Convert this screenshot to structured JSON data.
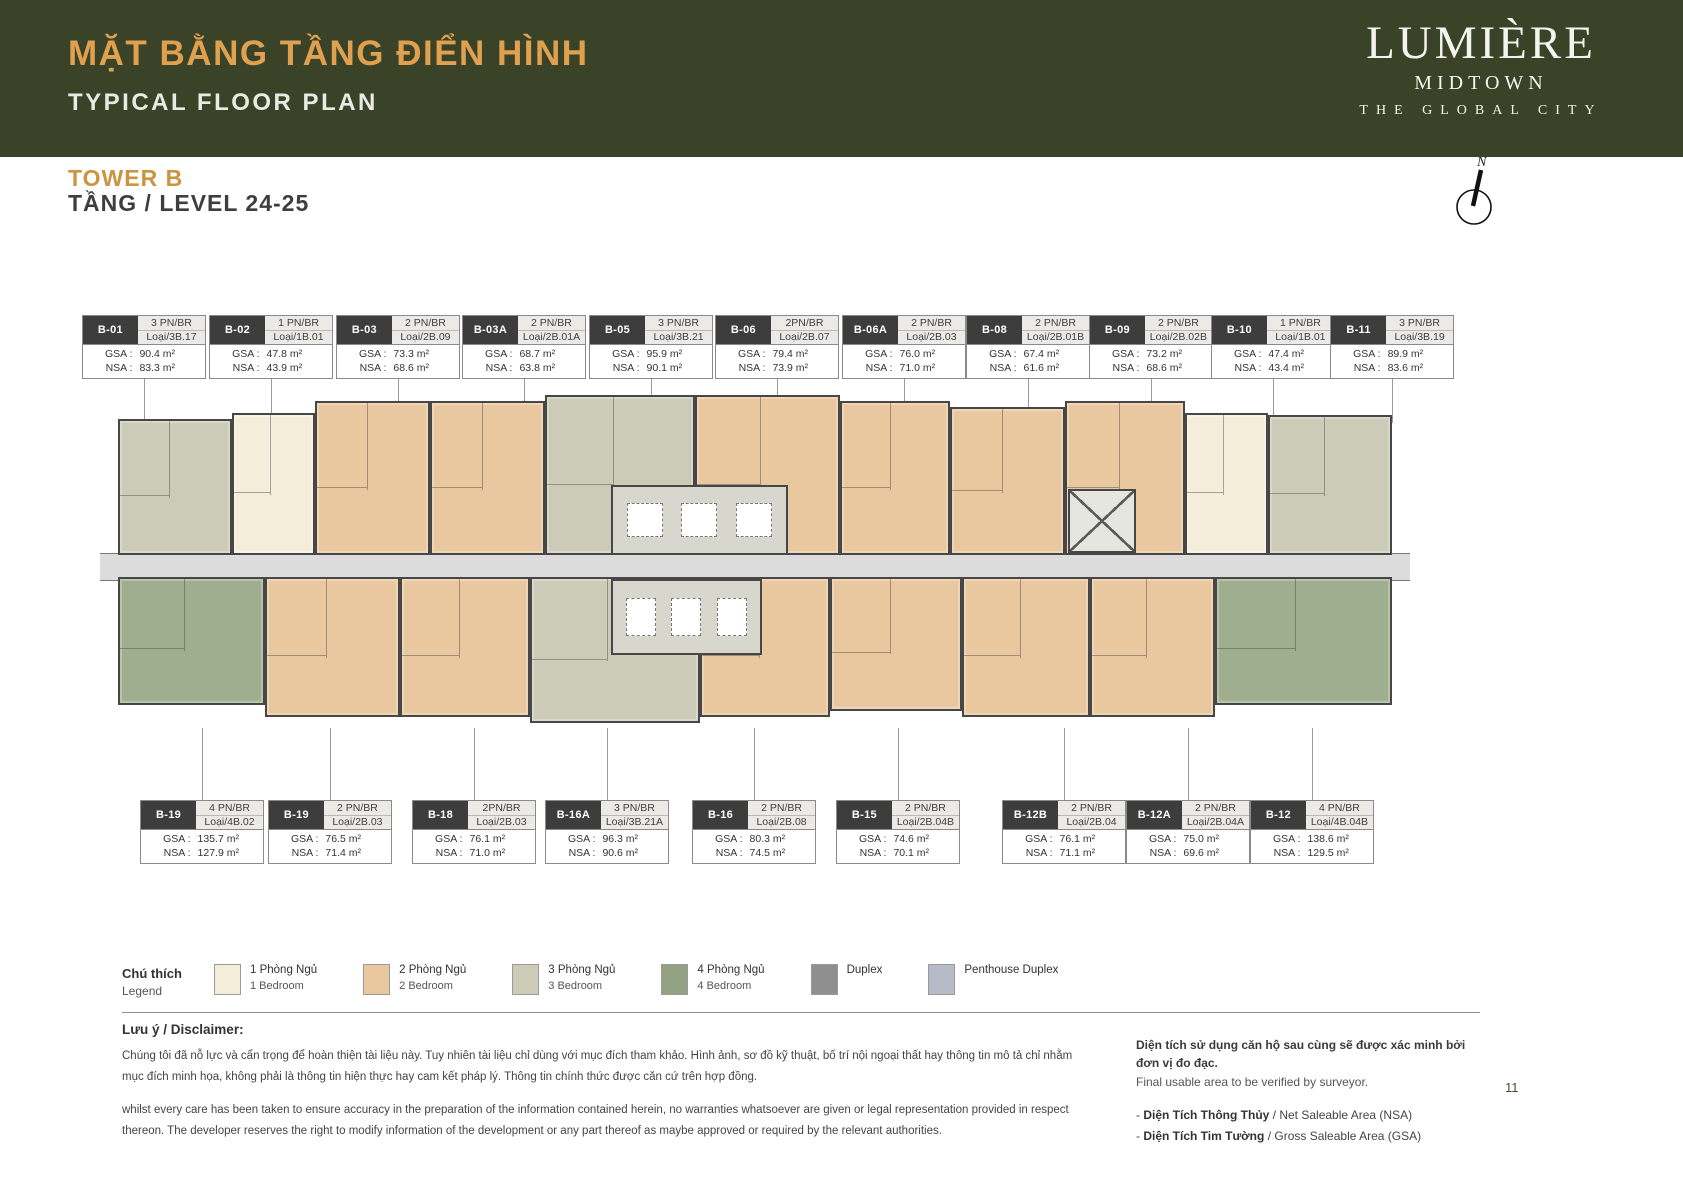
{
  "header": {
    "title_vi": "MẶT BẰNG TẦNG ĐIỂN HÌNH",
    "title_en": "TYPICAL FLOOR PLAN",
    "tower": "TOWER B",
    "level": "TẦNG / LEVEL 24-25",
    "logo": {
      "name": "LUMIÈRE",
      "sub": "MIDTOWN",
      "tagline": "THE GLOBAL CITY"
    },
    "north_label": "N"
  },
  "labels": {
    "gsa": "GSA :",
    "nsa": "NSA :"
  },
  "colors": {
    "header_bg": "#3a4227",
    "accent_gold": "#dfa150",
    "tower_gold": "#c9953f",
    "corridor": "#dcdcdc"
  },
  "unit_cards": {
    "top": [
      {
        "code": "B-01",
        "type": "3 PN/BR",
        "loai": "Loại/3B.17",
        "gsa": "90.4 m²",
        "nsa": "83.3 m²",
        "left": 4.87
      },
      {
        "code": "B-02",
        "type": "1 PN/BR",
        "loai": "Loại/1B.01",
        "gsa": "47.8 m²",
        "nsa": "43.9 m²",
        "left": 12.42
      },
      {
        "code": "B-03",
        "type": "2 PN/BR",
        "loai": "Loại/2B.09",
        "gsa": "73.3 m²",
        "nsa": "68.6 m²",
        "left": 19.96
      },
      {
        "code": "B-03A",
        "type": "2 PN/BR",
        "loai": "Loại/2B.01A",
        "gsa": "68.7 m²",
        "nsa": "63.8 m²",
        "left": 27.45
      },
      {
        "code": "B-05",
        "type": "3 PN/BR",
        "loai": "Loại/3B.21",
        "gsa": "95.9 m²",
        "nsa": "90.1 m²",
        "left": 35.0
      },
      {
        "code": "B-06",
        "type": "2PN/BR",
        "loai": "Loại/2B.07",
        "gsa": "79.4 m²",
        "nsa": "73.9 m²",
        "left": 42.48
      },
      {
        "code": "B-06A",
        "type": "2 PN/BR",
        "loai": "Loại/2B.03",
        "gsa": "76.0 m²",
        "nsa": "71.0 m²",
        "left": 50.03
      },
      {
        "code": "B-08",
        "type": "2 PN/BR",
        "loai": "Loại/2B.01B",
        "gsa": "67.4 m²",
        "nsa": "61.6 m²",
        "left": 57.4
      },
      {
        "code": "B-09",
        "type": "2 PN/BR",
        "loai": "Loại/2B.02B",
        "gsa": "73.2 m²",
        "nsa": "68.6 m²",
        "left": 64.7
      },
      {
        "code": "B-10",
        "type": "1 PN/BR",
        "loai": "Loại/1B.01",
        "gsa": "47.4 m²",
        "nsa": "43.4 m²",
        "left": 71.95
      },
      {
        "code": "B-11",
        "type": "3 PN/BR",
        "loai": "Loại/3B.19",
        "gsa": "89.9 m²",
        "nsa": "83.6 m²",
        "left": 79.03
      }
    ],
    "bottom": [
      {
        "code": "B-19",
        "type": "4 PN/BR",
        "loai": "Loại/4B.02",
        "gsa": "135.7 m²",
        "nsa": "127.9 m²",
        "left": 8.32
      },
      {
        "code": "B-19",
        "type": "2 PN/BR",
        "loai": "Loại/2B.03",
        "gsa": "76.5 m²",
        "nsa": "71.4 m²",
        "left": 15.92
      },
      {
        "code": "B-18",
        "type": "2PN/BR",
        "loai": "Loại/2B.03",
        "gsa": "76.1 m²",
        "nsa": "71.0 m²",
        "left": 24.48
      },
      {
        "code": "B-16A",
        "type": "3 PN/BR",
        "loai": "Loại/3B.21A",
        "gsa": "96.3 m²",
        "nsa": "90.6 m²",
        "left": 32.38
      },
      {
        "code": "B-16",
        "type": "2 PN/BR",
        "loai": "Loại/2B.08",
        "gsa": "80.3 m²",
        "nsa": "74.5 m²",
        "left": 41.12
      },
      {
        "code": "B-15",
        "type": "2 PN/BR",
        "loai": "Loại/2B.04B",
        "gsa": "74.6 m²",
        "nsa": "70.1 m²",
        "left": 49.67
      },
      {
        "code": "B-12B",
        "type": "2 PN/BR",
        "loai": "Loại/2B.04",
        "gsa": "76.1 m²",
        "nsa": "71.1 m²",
        "left": 59.54
      },
      {
        "code": "B-12A",
        "type": "2 PN/BR",
        "loai": "Loại/2B.04A",
        "gsa": "75.0 m²",
        "nsa": "69.6 m²",
        "left": 66.9
      },
      {
        "code": "B-12",
        "type": "4 PN/BR",
        "loai": "Loại/4B.04B",
        "gsa": "138.6 m²",
        "nsa": "129.5 m²",
        "left": 74.27
      }
    ]
  },
  "plan": {
    "type_colors": {
      "1BR": "#f3edda",
      "2BR": "#e9c79f",
      "3BR": "#cbcbb8",
      "4BR": "#9fae8e"
    },
    "top_blocks": [
      {
        "code": "B-01",
        "type": "3BR",
        "left": 1.37,
        "width": 8.7,
        "top": 26
      },
      {
        "code": "B-02",
        "type": "1BR",
        "left": 10.08,
        "width": 6.34,
        "top": 20
      },
      {
        "code": "B-03",
        "type": "2BR",
        "left": 16.41,
        "width": 8.78,
        "top": 8
      },
      {
        "code": "B-03A",
        "type": "2BR",
        "left": 25.19,
        "width": 8.78,
        "top": 8
      },
      {
        "code": "B-05",
        "type": "3BR",
        "left": 33.97,
        "width": 11.45,
        "top": 2
      },
      {
        "code": "B-06",
        "type": "2BR",
        "left": 45.42,
        "width": 11.07,
        "top": 2
      },
      {
        "code": "B-06A",
        "type": "2BR",
        "left": 56.49,
        "width": 8.4,
        "top": 8
      },
      {
        "code": "B-08",
        "type": "2BR",
        "left": 64.89,
        "width": 8.78,
        "top": 14
      },
      {
        "code": "B-09",
        "type": "2BR",
        "left": 73.66,
        "width": 9.16,
        "top": 8
      },
      {
        "code": "B-10",
        "type": "1BR",
        "left": 82.82,
        "width": 6.34,
        "top": 20
      },
      {
        "code": "B-11",
        "type": "3BR",
        "left": 89.16,
        "width": 9.47,
        "top": 22
      }
    ],
    "bottom_blocks": [
      {
        "code": "B-19",
        "type": "4BR",
        "left": 1.37,
        "width": 11.22,
        "height": 128
      },
      {
        "code": "B-19",
        "type": "2BR",
        "left": 12.6,
        "width": 10.3,
        "height": 140
      },
      {
        "code": "B-18",
        "type": "2BR",
        "left": 22.9,
        "width": 9.92,
        "height": 140
      },
      {
        "code": "B-16A",
        "type": "3BR",
        "left": 32.82,
        "width": 12.98,
        "height": 146
      },
      {
        "code": "B-16",
        "type": "2BR",
        "left": 45.8,
        "width": 9.92,
        "height": 140
      },
      {
        "code": "B-15",
        "type": "2BR",
        "left": 55.73,
        "width": 10.08,
        "height": 134
      },
      {
        "code": "B-12B",
        "type": "2BR",
        "left": 65.8,
        "width": 9.77,
        "height": 140
      },
      {
        "code": "B-12A",
        "type": "2BR",
        "left": 75.57,
        "width": 9.54,
        "height": 140
      },
      {
        "code": "B-12",
        "type": "4BR",
        "left": 85.11,
        "width": 13.51,
        "height": 128
      }
    ]
  },
  "legend": {
    "title_vi": "Chú thích",
    "title_en": "Legend",
    "items": [
      {
        "vi": "1 Phòng Ngủ",
        "en": "1 Bedroom",
        "color": "#f3edda"
      },
      {
        "vi": "2 Phòng Ngủ",
        "en": "2 Bedroom",
        "color": "#e9c79f"
      },
      {
        "vi": "3 Phòng Ngủ",
        "en": "3 Bedroom",
        "color": "#cbcbb8"
      },
      {
        "vi": "4 Phòng Ngủ",
        "en": "4 Bedroom",
        "color": "#91a181"
      },
      {
        "vi": "Duplex",
        "en": "",
        "color": "#8f8f8f"
      },
      {
        "vi": "Penthouse Duplex",
        "en": "",
        "color": "#b7bac7"
      }
    ]
  },
  "disclaimer": {
    "title": "Lưu ý / Disclaimer:",
    "vi": "Chúng tôi đã nỗ lực và cẩn trọng để hoàn thiện tài liệu này. Tuy nhiên tài liệu chỉ dùng với mục đích tham khảo. Hình ảnh, sơ đồ kỹ thuật, bố trí nội ngoại thất hay thông tin mô tả chỉ nhằm mục đích minh họa, không phải là thông tin hiện thực hay cam kết pháp lý. Thông tin chính thức được căn cứ trên hợp đồng.",
    "en": "whilst every care has been taken to ensure accuracy in the preparation of the information contained herein, no warranties whatsoever are given or legal representation provided in respect thereon. The developer reserves the right to modify information of the development or any part thereof as maybe approved or required by the relevant authorities."
  },
  "area_note": {
    "vi": "Diện tích sử dụng căn hộ sau cùng sẽ được xác minh bởi đơn vị đo đạc.",
    "en": "Final usable area to be verified by surveyor.",
    "bullets": [
      {
        "strong": "Diện Tích Thông Thủy",
        "rest": " / Net Saleable Area (NSA)"
      },
      {
        "strong": "Diện Tích Tim Tường",
        "rest": " / Gross Saleable Area (GSA)"
      }
    ]
  },
  "page_number": "11"
}
